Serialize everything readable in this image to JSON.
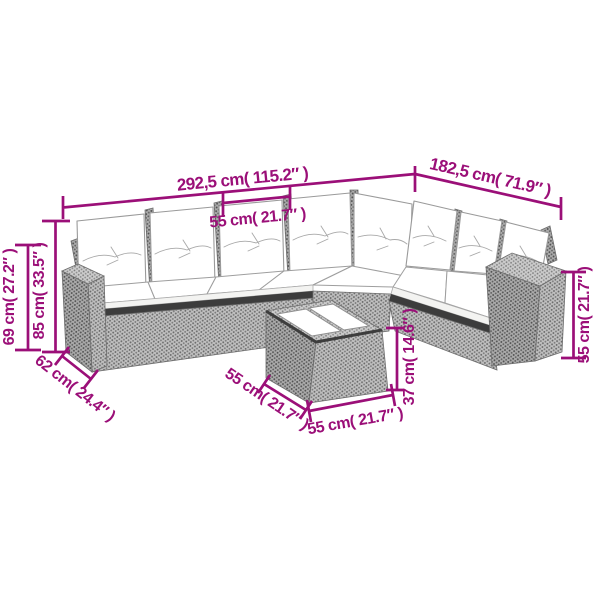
{
  "colors": {
    "dimension": "#9B0F78",
    "frame_gray": "#b3b3b3",
    "cushion_white": "#ffffff",
    "edge_dark": "#3c3c3c",
    "background": "#ffffff"
  },
  "dims": [
    {
      "id": "overall-width-left",
      "label": "292,5 cm( 115.2″ )"
    },
    {
      "id": "overall-width-right",
      "label": "182,5 cm( 71.9″ )"
    },
    {
      "id": "seat-width",
      "label": "55 cm( 21.7″ )"
    },
    {
      "id": "back-height",
      "label": "85 cm( 33.5″ )"
    },
    {
      "id": "arm-height",
      "label": "69 cm( 27.2″ )"
    },
    {
      "id": "seat-depth",
      "label": "62 cm( 24.4″ )"
    },
    {
      "id": "table-side-left",
      "label": "55 cm( 21.7″ )"
    },
    {
      "id": "table-side-front",
      "label": "55 cm( 21.7″ )"
    },
    {
      "id": "table-height",
      "label": "37 cm( 14.6″ )"
    },
    {
      "id": "armrest-side-height",
      "label": "55 cm( 21.7″ )"
    }
  ]
}
